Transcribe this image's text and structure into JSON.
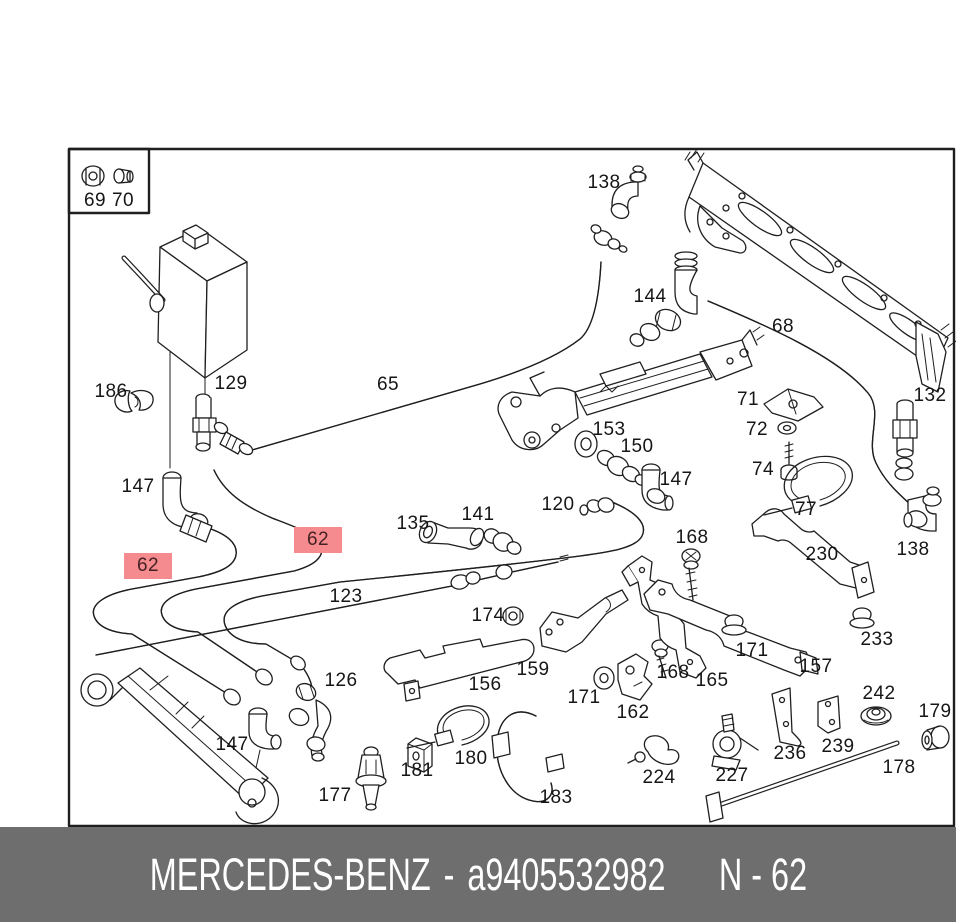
{
  "window": {
    "width": 956,
    "height": 922
  },
  "colors": {
    "paper": "#ffffff",
    "line": "#1f1f1f",
    "highlight_bg": "#f58b8e",
    "highlight_text": "#442123",
    "footer_bg": "#6e6e6e",
    "footer_text": "#ffffff"
  },
  "footer": {
    "brand": "MERCEDES-BENZ",
    "separator": "-",
    "part_number": "a9405532982",
    "sheet_ref": "N - 62"
  },
  "diagram": {
    "highlighted_part": "62",
    "labels": [
      {
        "text": "69",
        "x": 95,
        "y": 201
      },
      {
        "text": "70",
        "x": 123,
        "y": 201
      },
      {
        "text": "138",
        "x": 604,
        "y": 183
      },
      {
        "text": "144",
        "x": 650,
        "y": 297
      },
      {
        "text": "68",
        "x": 783,
        "y": 327
      },
      {
        "text": "65",
        "x": 388,
        "y": 385
      },
      {
        "text": "129",
        "x": 231,
        "y": 384
      },
      {
        "text": "186",
        "x": 111,
        "y": 392
      },
      {
        "text": "147",
        "x": 138,
        "y": 487
      },
      {
        "text": "71",
        "x": 748,
        "y": 400
      },
      {
        "text": "72",
        "x": 757,
        "y": 430
      },
      {
        "text": "74",
        "x": 763,
        "y": 470
      },
      {
        "text": "77",
        "x": 806,
        "y": 510
      },
      {
        "text": "132",
        "x": 930,
        "y": 396
      },
      {
        "text": "138",
        "x": 913,
        "y": 550
      },
      {
        "text": "153",
        "x": 609,
        "y": 430
      },
      {
        "text": "150",
        "x": 637,
        "y": 447
      },
      {
        "text": "147",
        "x": 676,
        "y": 480
      },
      {
        "text": "120",
        "x": 558,
        "y": 505
      },
      {
        "text": "141",
        "x": 478,
        "y": 515
      },
      {
        "text": "135",
        "x": 413,
        "y": 524
      },
      {
        "text": "62",
        "x": 148,
        "y": 566,
        "highlight": true
      },
      {
        "text": "62",
        "x": 318,
        "y": 540,
        "highlight": true
      },
      {
        "text": "123",
        "x": 346,
        "y": 597
      },
      {
        "text": "174",
        "x": 488,
        "y": 616
      },
      {
        "text": "168",
        "x": 692,
        "y": 538
      },
      {
        "text": "230",
        "x": 822,
        "y": 555
      },
      {
        "text": "233",
        "x": 877,
        "y": 640
      },
      {
        "text": "157",
        "x": 816,
        "y": 667
      },
      {
        "text": "171",
        "x": 752,
        "y": 651
      },
      {
        "text": "165",
        "x": 712,
        "y": 681
      },
      {
        "text": "168",
        "x": 673,
        "y": 673
      },
      {
        "text": "159",
        "x": 533,
        "y": 670
      },
      {
        "text": "156",
        "x": 485,
        "y": 685
      },
      {
        "text": "126",
        "x": 341,
        "y": 681
      },
      {
        "text": "171",
        "x": 584,
        "y": 698
      },
      {
        "text": "162",
        "x": 633,
        "y": 713
      },
      {
        "text": "242",
        "x": 879,
        "y": 694
      },
      {
        "text": "179",
        "x": 935,
        "y": 712
      },
      {
        "text": "147",
        "x": 232,
        "y": 745
      },
      {
        "text": "177",
        "x": 335,
        "y": 796
      },
      {
        "text": "181",
        "x": 417,
        "y": 771
      },
      {
        "text": "180",
        "x": 471,
        "y": 759
      },
      {
        "text": "183",
        "x": 556,
        "y": 798
      },
      {
        "text": "224",
        "x": 659,
        "y": 778
      },
      {
        "text": "227",
        "x": 732,
        "y": 776
      },
      {
        "text": "236",
        "x": 790,
        "y": 754
      },
      {
        "text": "239",
        "x": 838,
        "y": 747
      },
      {
        "text": "178",
        "x": 899,
        "y": 768
      }
    ]
  }
}
